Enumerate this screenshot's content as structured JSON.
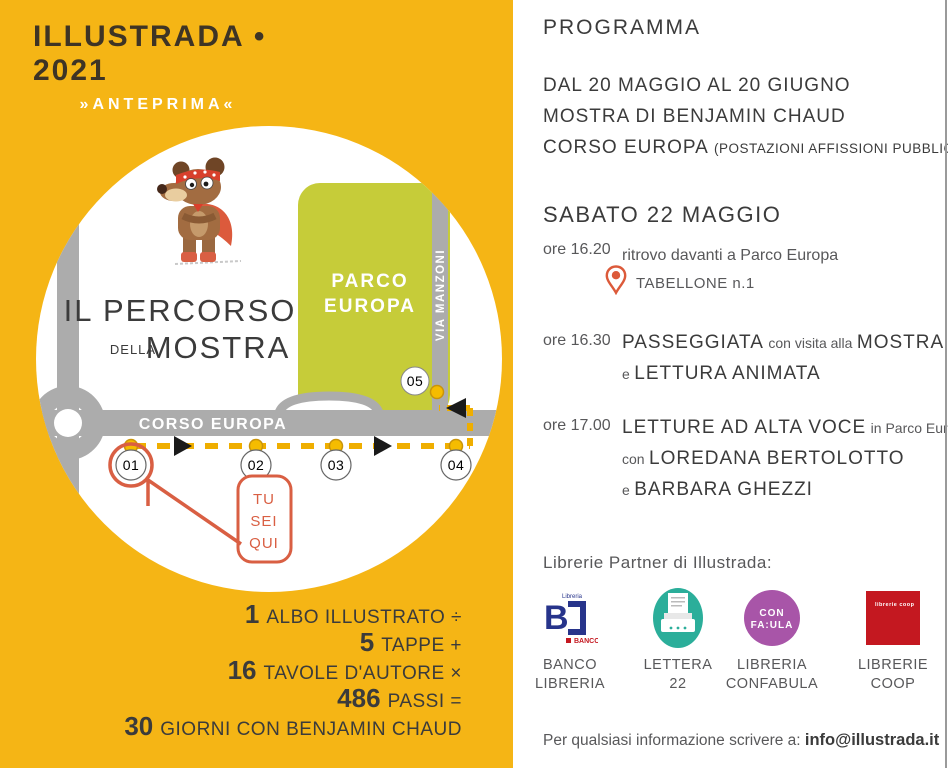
{
  "colors": {
    "background_yellow": "#F5B515",
    "park_green": "#C6CC39",
    "road_grey": "#ACACAC",
    "accent_orange": "#D95F43",
    "route_yellow": "#EFAE00",
    "text_dark": "#3B3B3B",
    "text_grey": "#58585A",
    "logo_teal": "#2BAE9A",
    "logo_purple": "#A855A8",
    "logo_red": "#C41820",
    "logo_blue": "#27348B"
  },
  "left_panel": {
    "logo": {
      "title": "ILLUSTRADA",
      "separator": "•",
      "year": "2021",
      "subtitle": "»ANTEPRIMA«"
    },
    "map": {
      "title_line1": "IL PERCORSO",
      "title_article": "DELLA",
      "title_line2": "MOSTRA",
      "park_line1": "PARCO",
      "park_line2": "EUROPA",
      "street_vertical": "VIA MANZONI",
      "street_horizontal": "CORSO EUROPA",
      "stops": [
        "01",
        "02",
        "03",
        "04",
        "05"
      ],
      "you_are_here": [
        "TU",
        "SEI",
        "QUI"
      ]
    },
    "equation": [
      {
        "num": "1",
        "text": "ALBO ILLUSTRATO ÷"
      },
      {
        "num": "5",
        "text": "TAPPE +"
      },
      {
        "num": "16",
        "text": "TAVOLE D'AUTORE ×"
      },
      {
        "num": "486",
        "text": "PASSI ="
      },
      {
        "num": "30",
        "text": "GIORNI CON BENJAMIN CHAUD"
      }
    ]
  },
  "right_panel": {
    "heading": "PROGRAMMA",
    "dates": {
      "line1": "DAL 20 MAGGIO AL 20 GIUGNO",
      "line2": "MOSTRA DI BENJAMIN CHAUD",
      "line3": "CORSO EUROPA",
      "line3_note": "(POSTAZIONI AFFISSIONI PUBBLICHE)"
    },
    "day_heading": "SABATO 22 MAGGIO",
    "event1": {
      "time": "ore 16.20",
      "text": "ritrovo davanti a Parco Europa",
      "pin_label": "TABELLONE n.1"
    },
    "event2": {
      "time": "ore 16.30",
      "t1": "PASSEGGIATA",
      "m1": "con visita alla",
      "t2": "MOSTRA",
      "m2": "e",
      "t3": "LETTURA ANIMATA"
    },
    "event3": {
      "time": "ore 17.00",
      "t1": "LETTURE AD ALTA VOCE",
      "m1": "in Parco Europa",
      "m2": "con",
      "t2": "LOREDANA BERTOLOTTO",
      "m3": "e",
      "t3": "BARBARA GHEZZI"
    },
    "partners_heading": "Librerie Partner di Illustrada:",
    "partners": [
      {
        "label1": "BANCO",
        "label2": "LIBRERIA",
        "logo_letter": "B",
        "logo_small": "Libreria",
        "logo_text": "BANCO"
      },
      {
        "label1": "LETTERA",
        "label2": "22"
      },
      {
        "label1": "LIBRERIA",
        "label2": "CONFABULA",
        "logo_line1": "CON",
        "logo_line2": "FA:ULA"
      },
      {
        "label1": "LIBRERIE",
        "label2": "COOP",
        "logo_text": "librerie coop"
      }
    ],
    "contact_prefix": "Per qualsiasi informazione scrivere a: ",
    "contact_email": "info@illustrada.it"
  }
}
